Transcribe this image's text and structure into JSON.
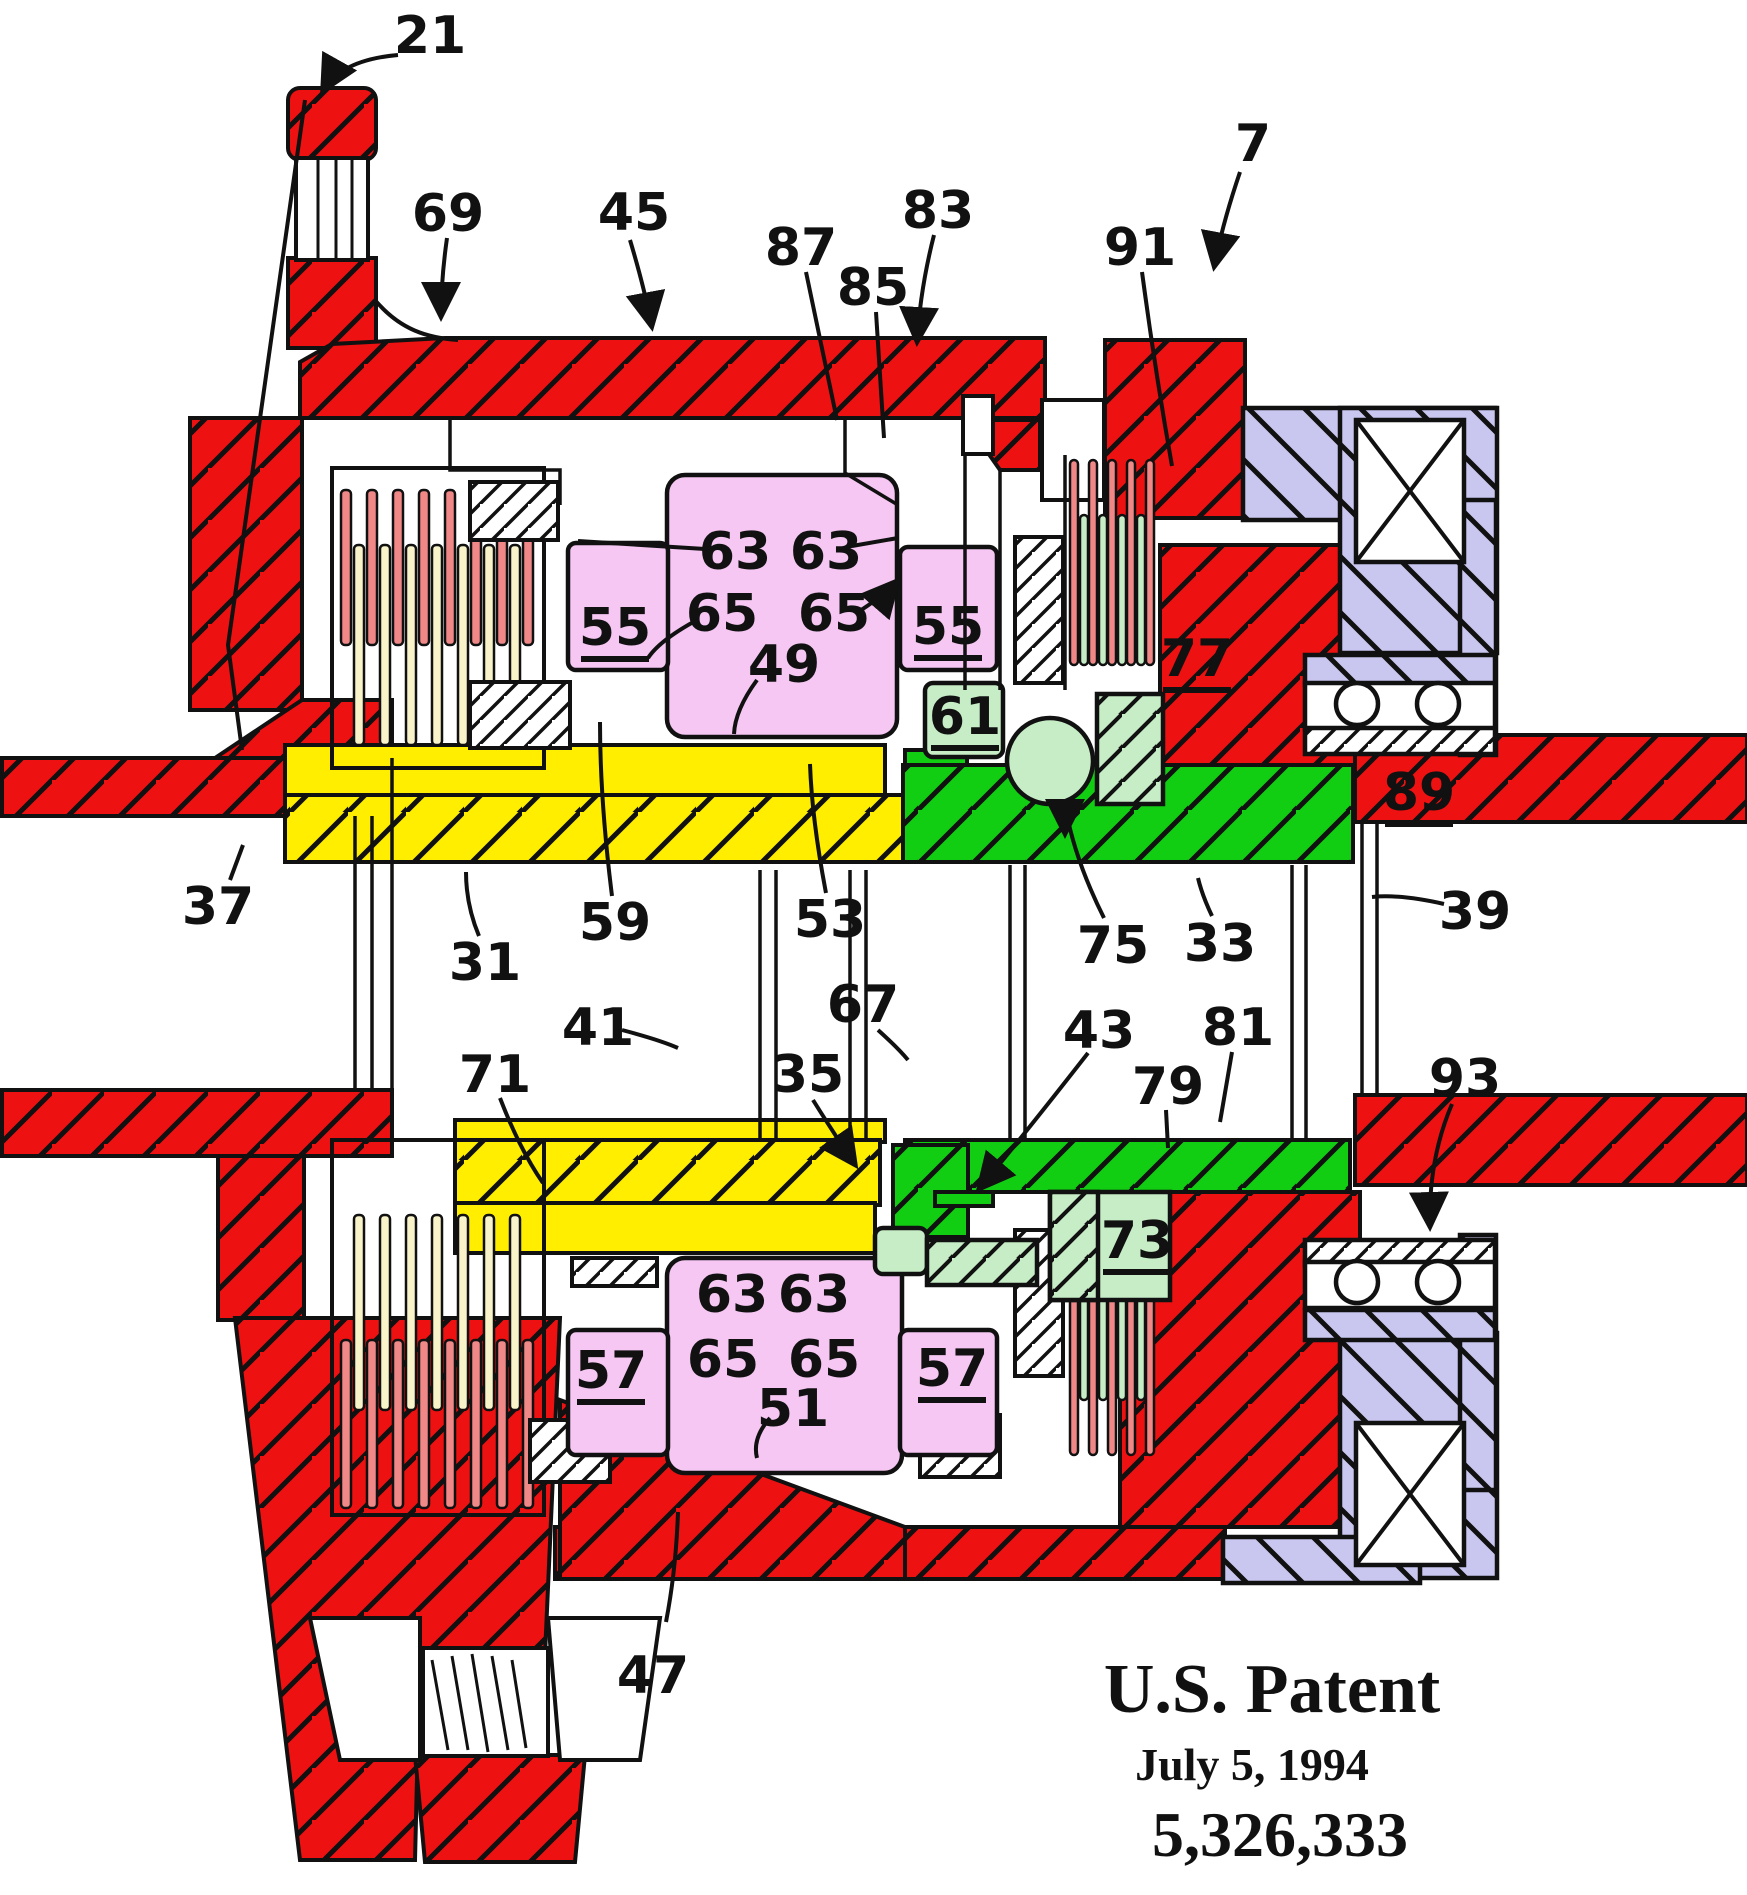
{
  "figure": {
    "title_hidden": "",
    "patent_stamp": {
      "line1": "U.S. Patent",
      "line2": "July 5, 1994",
      "line3": "5,326,333"
    },
    "colors": {
      "case_red": "#EE1111",
      "hub_yellow": "#FFEE00",
      "ring_green": "#12CE12",
      "pale_green": "#C7EDC7",
      "gear_pink": "#F5C7F2",
      "bearing_lavender": "#C9C7F0",
      "clutch_salmon": "#F08888",
      "clutch_cream": "#F8F3C8",
      "line_black": "#111111"
    },
    "reference_labels": [
      {
        "text": "21",
        "x": 430,
        "y": 35,
        "underline": false
      },
      {
        "text": "7",
        "x": 1253,
        "y": 143,
        "underline": false
      },
      {
        "text": "69",
        "x": 448,
        "y": 213,
        "underline": false
      },
      {
        "text": "45",
        "x": 634,
        "y": 212,
        "underline": false
      },
      {
        "text": "87",
        "x": 801,
        "y": 247,
        "underline": false
      },
      {
        "text": "85",
        "x": 873,
        "y": 287,
        "underline": false
      },
      {
        "text": "83",
        "x": 938,
        "y": 210,
        "underline": false
      },
      {
        "text": "91",
        "x": 1140,
        "y": 247,
        "underline": false
      },
      {
        "text": "63",
        "x": 735,
        "y": 551,
        "underline": false
      },
      {
        "text": "63",
        "x": 826,
        "y": 551,
        "underline": false
      },
      {
        "text": "65",
        "x": 722,
        "y": 613,
        "underline": false
      },
      {
        "text": "65",
        "x": 834,
        "y": 613,
        "underline": false
      },
      {
        "text": "55",
        "x": 615,
        "y": 627,
        "underline": true
      },
      {
        "text": "55",
        "x": 948,
        "y": 626,
        "underline": true
      },
      {
        "text": "49",
        "x": 784,
        "y": 664,
        "underline": false
      },
      {
        "text": "61",
        "x": 965,
        "y": 716,
        "underline": true
      },
      {
        "text": "77",
        "x": 1197,
        "y": 658,
        "underline": true
      },
      {
        "text": "89",
        "x": 1419,
        "y": 792,
        "underline": true
      },
      {
        "text": "37",
        "x": 218,
        "y": 906,
        "underline": false
      },
      {
        "text": "31",
        "x": 485,
        "y": 962,
        "underline": false
      },
      {
        "text": "59",
        "x": 615,
        "y": 922,
        "underline": false
      },
      {
        "text": "53",
        "x": 830,
        "y": 919,
        "underline": false
      },
      {
        "text": "41",
        "x": 598,
        "y": 1027,
        "underline": false
      },
      {
        "text": "67",
        "x": 863,
        "y": 1004,
        "underline": false
      },
      {
        "text": "71",
        "x": 495,
        "y": 1074,
        "underline": false
      },
      {
        "text": "35",
        "x": 808,
        "y": 1074,
        "underline": false
      },
      {
        "text": "75",
        "x": 1113,
        "y": 945,
        "underline": false
      },
      {
        "text": "33",
        "x": 1220,
        "y": 943,
        "underline": false
      },
      {
        "text": "43",
        "x": 1099,
        "y": 1030,
        "underline": false
      },
      {
        "text": "81",
        "x": 1238,
        "y": 1027,
        "underline": false
      },
      {
        "text": "79",
        "x": 1168,
        "y": 1086,
        "underline": false
      },
      {
        "text": "39",
        "x": 1475,
        "y": 911,
        "underline": false
      },
      {
        "text": "93",
        "x": 1465,
        "y": 1078,
        "underline": false
      },
      {
        "text": "63",
        "x": 732,
        "y": 1294,
        "underline": false
      },
      {
        "text": "63",
        "x": 814,
        "y": 1294,
        "underline": false
      },
      {
        "text": "65",
        "x": 723,
        "y": 1359,
        "underline": false
      },
      {
        "text": "65",
        "x": 824,
        "y": 1359,
        "underline": false
      },
      {
        "text": "57",
        "x": 611,
        "y": 1370,
        "underline": true
      },
      {
        "text": "57",
        "x": 952,
        "y": 1368,
        "underline": true
      },
      {
        "text": "51",
        "x": 793,
        "y": 1408,
        "underline": false
      },
      {
        "text": "73",
        "x": 1137,
        "y": 1240,
        "underline": true
      },
      {
        "text": "47",
        "x": 653,
        "y": 1675,
        "underline": false
      }
    ]
  }
}
